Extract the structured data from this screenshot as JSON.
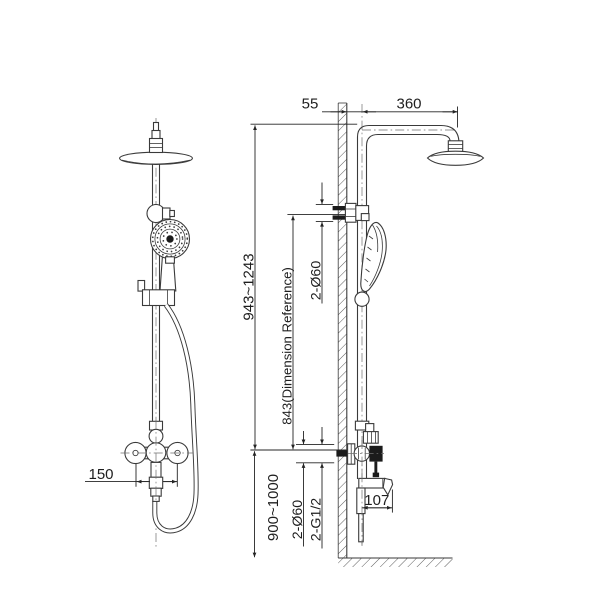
{
  "drawing": {
    "background": "#ffffff",
    "line_color": "#3a3a3a",
    "accent_black": "#1b1b1b"
  },
  "dimensions": {
    "front_valve_spacing": "150",
    "wall_to_riser": "55",
    "arm_reach": "360",
    "overall_height": "943~1243",
    "reference_height": "843(Dimension Reference)",
    "upper_wall_flanges": "2-Ø60",
    "mixer_install_height": "900~1000",
    "lower_wall_flanges": "2-Ø60",
    "inlet_connections": "2-G1/2",
    "spout_reach": "107"
  }
}
